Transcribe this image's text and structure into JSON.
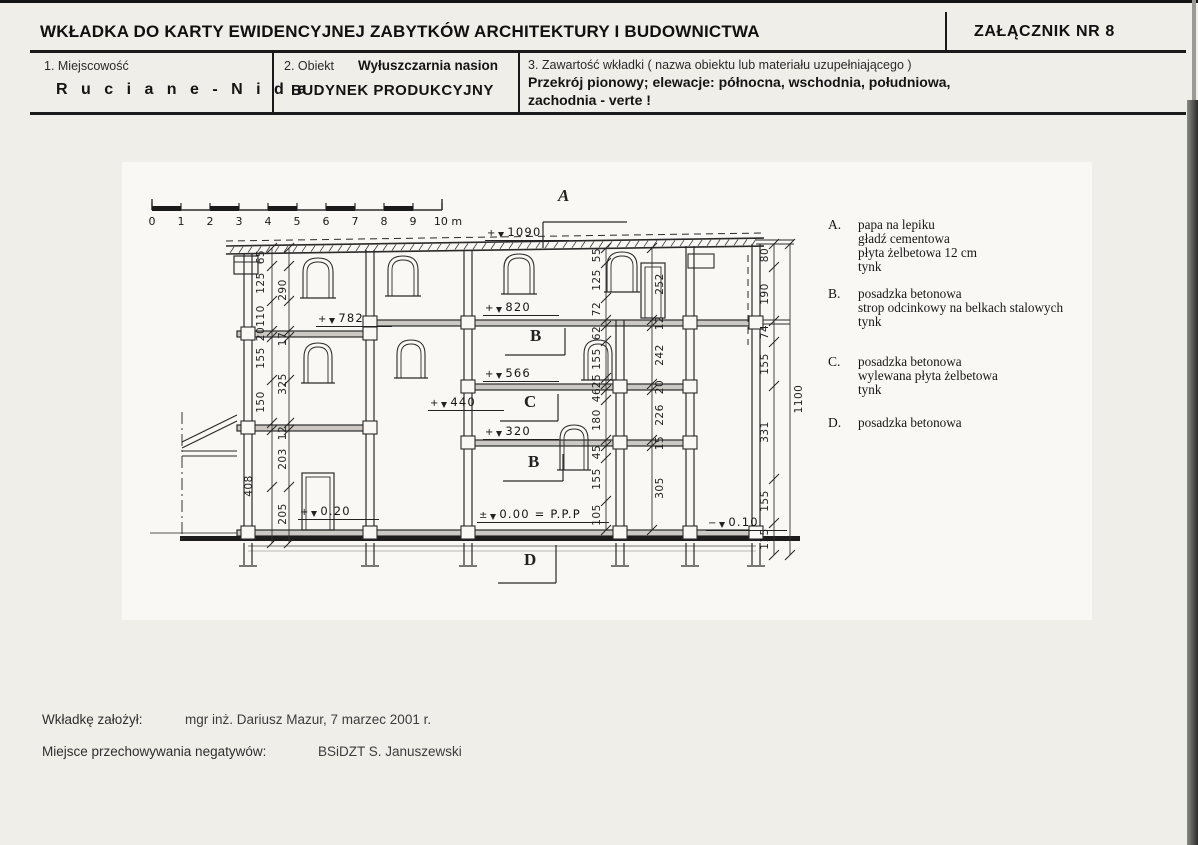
{
  "header": {
    "title": "WKŁADKA DO KARTY EWIDENCYJNEJ ZABYTKÓW ARCHITEKTURY I BUDOWNICTWA",
    "attachment": "ZAŁĄCZNIK NR 8"
  },
  "fields": {
    "f1_label": "1. Miejscowość",
    "f1_value": "R u c i a n e - N i d a",
    "f2_label": "2. Obiekt",
    "f2_object": "Wyłuszczarnia nasion",
    "f2_value": "BUDYNEK PRODUKCYJNY",
    "f3_label": "3. Zawartość wkładki ( nazwa obiektu lub materiału uzupełniającego )",
    "f3_line1": "Przekrój pionowy; elewacje: północna, wschodnia, południowa,",
    "f3_line2": "zachodnia - verte !"
  },
  "drawing": {
    "scale_ticks": [
      "0",
      "1",
      "2",
      "3",
      "4",
      "5",
      "6",
      "7",
      "8",
      "9",
      "10 m"
    ],
    "section_labels": {
      "roof": "A",
      "upper": "B",
      "middle": "C",
      "lower": "B",
      "ground": "D"
    },
    "levels": [
      {
        "sign": "+",
        "value": "1090"
      },
      {
        "sign": "+",
        "value": "820"
      },
      {
        "sign": "+",
        "value": "782"
      },
      {
        "sign": "+",
        "value": "566"
      },
      {
        "sign": "+",
        "value": "440"
      },
      {
        "sign": "+",
        "value": "320"
      },
      {
        "sign": "+",
        "value": "0.20"
      },
      {
        "sign": "±",
        "value": "0.00 = P.P.P"
      },
      {
        "sign": "−",
        "value": "0.10"
      }
    ],
    "dims": {
      "left_outer": [
        "65",
        "125",
        "110",
        "20",
        "155",
        "150",
        "408"
      ],
      "left_inner": [
        "290",
        "17",
        "325",
        "12",
        "203",
        "205"
      ],
      "mid_a": [
        "55",
        "125",
        "72",
        "62",
        "155",
        "25",
        "46",
        "180",
        "45",
        "155",
        "105"
      ],
      "mid_b": [
        "252",
        "12",
        "242",
        "20",
        "226",
        "15",
        "305"
      ],
      "right_inner": [
        "80",
        "190",
        "74",
        "155",
        "331",
        "155",
        "115"
      ],
      "right_total": "1100"
    }
  },
  "legend": {
    "items": [
      {
        "key": "A.",
        "lines": [
          "papa na lepiku",
          "gładź cementowa",
          "płyta żelbetowa 12 cm",
          "tynk"
        ]
      },
      {
        "key": "B.",
        "lines": [
          "posadzka betonowa",
          "strop odcinkowy na belkach stalowych",
          "tynk"
        ]
      },
      {
        "key": "C.",
        "lines": [
          "posadzka betonowa",
          "wylewana płyta żelbetowa",
          "tynk"
        ]
      },
      {
        "key": "D.",
        "lines": [
          "posadzka betonowa"
        ]
      }
    ]
  },
  "footer": {
    "row1_label": "Wkładkę założył:",
    "row1_value": "mgr inż. Dariusz Mazur, 7 marzec 2001 r.",
    "row2_label": "Miejsce przechowywania negatywów:",
    "row2_value": "BSiDZT S. Januszewski"
  }
}
